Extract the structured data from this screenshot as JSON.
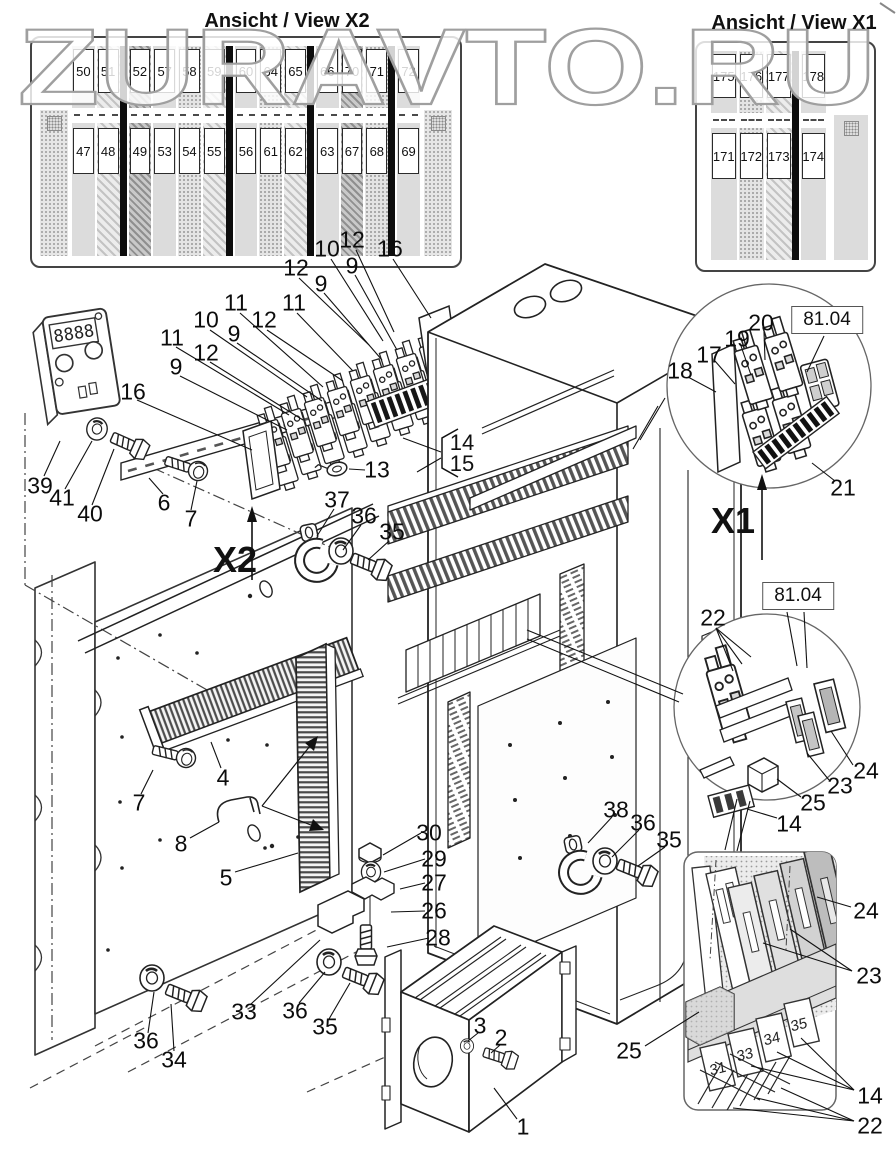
{
  "watermark": "ZURAVTO.RU",
  "views": {
    "x2": {
      "title": "Ansicht / View X2",
      "columns": [
        {
          "top": "50",
          "bottom": "47"
        },
        {
          "top": "51",
          "bottom": "48"
        },
        {
          "top": "52",
          "bottom": "49"
        },
        {
          "top": "57",
          "bottom": "53"
        },
        {
          "top": "58",
          "bottom": "54"
        },
        {
          "top": "59",
          "bottom": "55"
        },
        {
          "top": "60",
          "bottom": "56"
        },
        {
          "top": "64",
          "bottom": "61"
        },
        {
          "top": "65",
          "bottom": "62"
        },
        {
          "top": "66",
          "bottom": "63"
        },
        {
          "top": "70",
          "bottom": "67"
        },
        {
          "top": "71",
          "bottom": "68"
        },
        {
          "top": "72",
          "bottom": "69"
        }
      ]
    },
    "x1": {
      "title": "Ansicht / View X1",
      "columns": [
        {
          "top": "175",
          "bottom": "171"
        },
        {
          "top": "176",
          "bottom": "172"
        },
        {
          "top": "177",
          "bottom": "173"
        },
        {
          "top": "178",
          "bottom": "174"
        }
      ]
    }
  },
  "markers": {
    "x2_label": "X2",
    "x1_label": "X1"
  },
  "refs": [
    "81.04",
    "81.04"
  ],
  "bracket": {
    "top": "14",
    "bottom": "15"
  },
  "device_display": "8888",
  "fuse_labels": [
    {
      "t": "31",
      "x": 718,
      "y": 1069
    },
    {
      "t": "33",
      "x": 745,
      "y": 1055
    },
    {
      "t": "34",
      "x": 772,
      "y": 1039
    },
    {
      "t": "35",
      "x": 799,
      "y": 1025
    }
  ],
  "callouts": [
    {
      "t": "12",
      "x": 352,
      "y": 240
    },
    {
      "t": "10",
      "x": 327,
      "y": 249
    },
    {
      "t": "16",
      "x": 390,
      "y": 249
    },
    {
      "t": "9",
      "x": 352,
      "y": 266
    },
    {
      "t": "12",
      "x": 296,
      "y": 268
    },
    {
      "t": "9",
      "x": 321,
      "y": 284
    },
    {
      "t": "11",
      "x": 294,
      "y": 303
    },
    {
      "t": "11",
      "x": 236,
      "y": 303
    },
    {
      "t": "12",
      "x": 264,
      "y": 320
    },
    {
      "t": "10",
      "x": 206,
      "y": 320
    },
    {
      "t": "9",
      "x": 234,
      "y": 334
    },
    {
      "t": "11",
      "x": 172,
      "y": 338
    },
    {
      "t": "12",
      "x": 206,
      "y": 353
    },
    {
      "t": "9",
      "x": 176,
      "y": 367
    },
    {
      "t": "16",
      "x": 133,
      "y": 392
    },
    {
      "t": "13",
      "x": 377,
      "y": 470
    },
    {
      "t": "39",
      "x": 40,
      "y": 486
    },
    {
      "t": "41",
      "x": 62,
      "y": 498
    },
    {
      "t": "40",
      "x": 90,
      "y": 514
    },
    {
      "t": "6",
      "x": 164,
      "y": 503
    },
    {
      "t": "7",
      "x": 191,
      "y": 519
    },
    {
      "t": "37",
      "x": 337,
      "y": 500
    },
    {
      "t": "36",
      "x": 364,
      "y": 516
    },
    {
      "t": "35",
      "x": 392,
      "y": 532
    },
    {
      "t": "4",
      "x": 223,
      "y": 778
    },
    {
      "t": "7",
      "x": 139,
      "y": 803
    },
    {
      "t": "8",
      "x": 181,
      "y": 844
    },
    {
      "t": "5",
      "x": 226,
      "y": 878
    },
    {
      "t": "30",
      "x": 429,
      "y": 833
    },
    {
      "t": "29",
      "x": 434,
      "y": 859
    },
    {
      "t": "27",
      "x": 434,
      "y": 883
    },
    {
      "t": "26",
      "x": 434,
      "y": 911
    },
    {
      "t": "28",
      "x": 438,
      "y": 938
    },
    {
      "t": "36",
      "x": 146,
      "y": 1041
    },
    {
      "t": "34",
      "x": 174,
      "y": 1060
    },
    {
      "t": "33",
      "x": 244,
      "y": 1012
    },
    {
      "t": "36",
      "x": 295,
      "y": 1011
    },
    {
      "t": "35",
      "x": 325,
      "y": 1027
    },
    {
      "t": "3",
      "x": 480,
      "y": 1026
    },
    {
      "t": "2",
      "x": 501,
      "y": 1038
    },
    {
      "t": "1",
      "x": 523,
      "y": 1127
    },
    {
      "t": "38",
      "x": 616,
      "y": 810
    },
    {
      "t": "36",
      "x": 643,
      "y": 823
    },
    {
      "t": "35",
      "x": 669,
      "y": 840
    },
    {
      "t": "18",
      "x": 680,
      "y": 371
    },
    {
      "t": "17",
      "x": 709,
      "y": 355
    },
    {
      "t": "19",
      "x": 737,
      "y": 339
    },
    {
      "t": "20",
      "x": 761,
      "y": 323
    },
    {
      "t": "21",
      "x": 843,
      "y": 488
    },
    {
      "t": "22",
      "x": 713,
      "y": 618
    },
    {
      "t": "24",
      "x": 866,
      "y": 771
    },
    {
      "t": "23",
      "x": 840,
      "y": 786
    },
    {
      "t": "25",
      "x": 813,
      "y": 803
    },
    {
      "t": "14",
      "x": 789,
      "y": 824
    },
    {
      "t": "24",
      "x": 866,
      "y": 911
    },
    {
      "t": "23",
      "x": 869,
      "y": 976
    },
    {
      "t": "25",
      "x": 629,
      "y": 1051
    },
    {
      "t": "14",
      "x": 870,
      "y": 1096
    },
    {
      "t": "22",
      "x": 870,
      "y": 1126
    }
  ]
}
